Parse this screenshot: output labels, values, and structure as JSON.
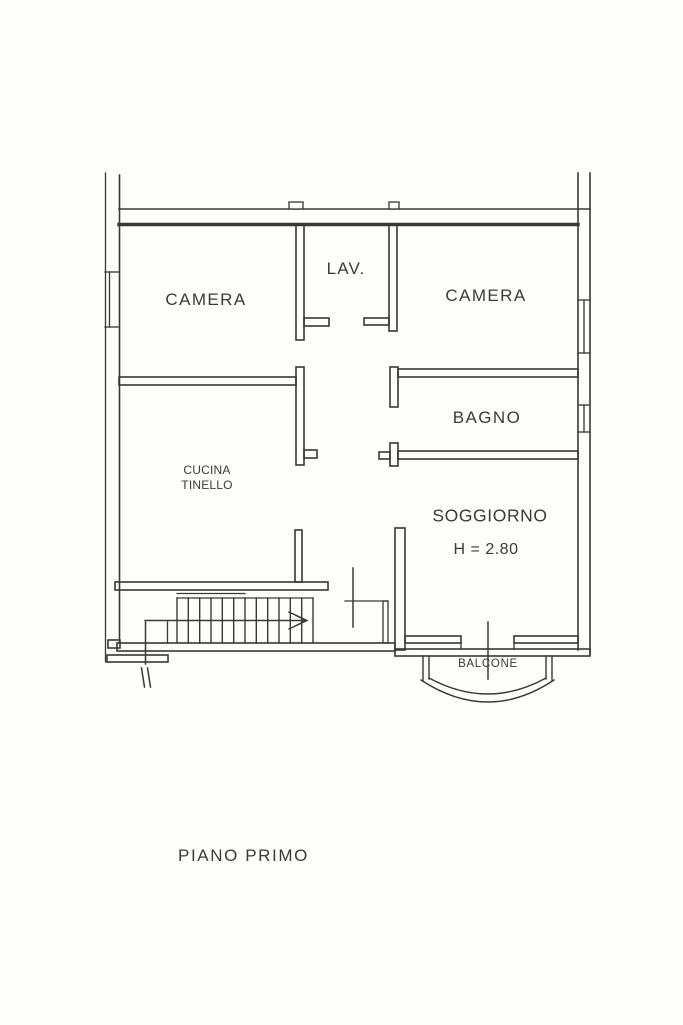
{
  "page": {
    "background_color": "#fdfdfb",
    "ink_color": "#383838",
    "text_color": "#3a3a3a"
  },
  "plan": {
    "floor_title": "PIANO PRIMO",
    "rooms": {
      "camera_left": "CAMERA",
      "lav": "LAV.",
      "camera_right": "CAMERA",
      "bagno": "BAGNO",
      "cucina_line1": "CUCINA",
      "cucina_line2": "TINELLO",
      "soggiorno": "SOGGIORNO",
      "soggiorno_height": "H = 2.80",
      "balcone": "BALCONE"
    },
    "symbols": {
      "stair_arrow_icon": "arrow-right",
      "window_icon": "double-line-window",
      "door_icon": "door-leaf-line"
    }
  }
}
